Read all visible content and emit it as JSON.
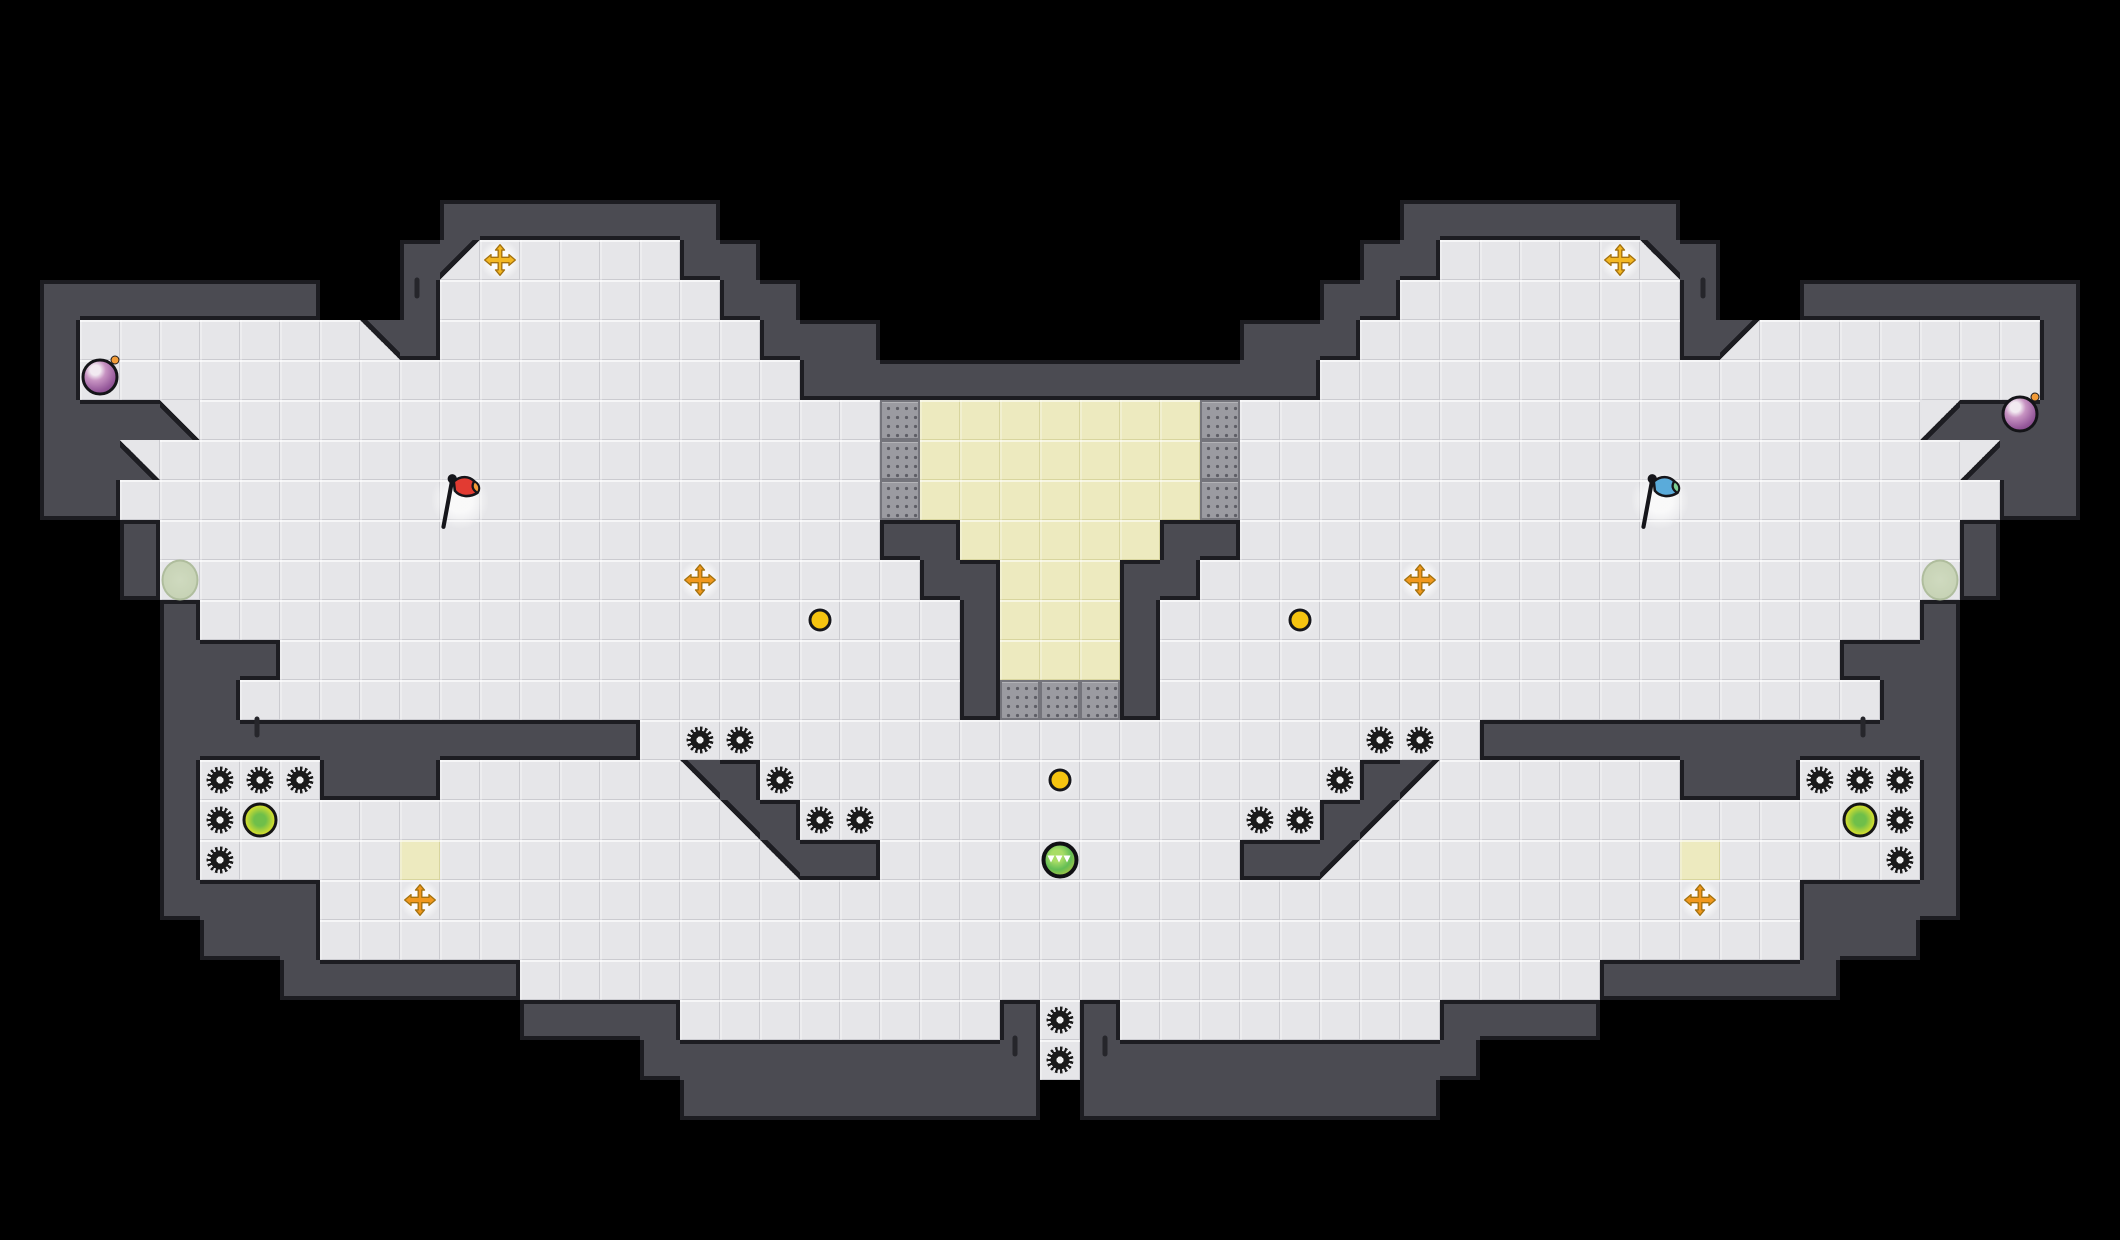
{
  "scene": {
    "description": "top-down tile arena map, capture-the-flag layout, mirrored left-right on black void",
    "background_color": "#000000"
  },
  "colors": {
    "void": "#000000",
    "wall_fill": "#4b4b52",
    "wall_edge": "#1d1d22",
    "floor": "#e6e6e9",
    "floor_line": "#cbcbd0",
    "sand_floor": "#edeabf",
    "dotted_block": "#9b9ba1",
    "dotted_dot": "#5e5e66",
    "mine": "#1b1b1b",
    "coin": "#f6c411",
    "orb_lime": "#d9e02e",
    "orb_ninja_green": "#63bd55",
    "cross_gold": "#f3b722",
    "cross_amber": "#f0981d",
    "bomb_purple": "#95589a",
    "bomb_spark": "#f29b38",
    "flag_red_body": "#e23b32",
    "flag_red_tip": "#f29b38",
    "flag_blue_body": "#5aabda",
    "flag_blue_tip": "#7ccf93",
    "spawn_oval": "#cfdabf"
  },
  "map": {
    "tile_size": 40,
    "cols": 53,
    "rows": 31,
    "legend": {
      " ": "void",
      "#": "wall",
      ".": "floor",
      "y": "sand-floor",
      "d": "dotted-block",
      "a": "wall-diagonal-top-left",
      "b": "wall-diagonal-top-right",
      "c": "wall-diagonal-bottom-left",
      "e": "wall-diagonal-bottom-right"
    },
    "grid": [
      "                                                     ",
      "                                                     ",
      "                                                     ",
      "                                                     ",
      "                                                     ",
      "           #######                 #######           ",
      "          #a.....##               ##.....b#          ",
      " #######  #.......##             ##.......#  ####### ",
      " #.......b#........###         ###........#a.......# ",
      " #..................#############..................# ",
      " ###c.................dyyyyyyyd.................e### ",
      " ##c..................dyyyyyyyd..................e## ",
      " ##...................dyyyyyyyd...................## ",
      "   #..................##yyyyy##..................#   ",
      "   #...................##yyy##...................#   ",
      "    #...................#yyy#...................#    ",
      "    ###.................#yyy#.................###    ",
      "    ##..................#ddd#..................##    ",
      "    ############.....................############    ",
      "    #...###......b#...............#a......###...#    ",
      "    #.............b#.............#a.............#    ",
      "    #.....y........b##.........##a........y.....#    ",
      "    ####.....................................####    ",
      "     ###.....................................###     ",
      "       ######...........................######       ",
      "             ####........#.#........####             ",
      "                ##########.##########                ",
      "                 ######### #########                 ",
      "                                                     ",
      "                                                     ",
      "                                                     "
    ]
  },
  "entities": {
    "mines": [
      [
        5,
        19
      ],
      [
        6,
        19
      ],
      [
        7,
        19
      ],
      [
        5,
        20
      ],
      [
        5,
        21
      ],
      [
        17,
        18
      ],
      [
        18,
        18
      ],
      [
        19,
        19
      ],
      [
        20,
        20
      ],
      [
        21,
        20
      ],
      [
        45,
        19
      ],
      [
        46,
        19
      ],
      [
        47,
        19
      ],
      [
        47,
        20
      ],
      [
        47,
        21
      ],
      [
        35,
        18
      ],
      [
        34,
        18
      ],
      [
        33,
        19
      ],
      [
        32,
        20
      ],
      [
        31,
        20
      ],
      [
        26,
        25
      ],
      [
        26,
        26
      ]
    ],
    "coins": [
      [
        20,
        15
      ],
      [
        32,
        15
      ],
      [
        26,
        19
      ]
    ],
    "power_orbs_lime": [
      [
        6,
        20
      ],
      [
        46,
        20
      ]
    ],
    "ninja_orbs": [
      [
        26,
        21
      ]
    ],
    "launch_crosses_gold": [
      [
        12,
        6
      ],
      [
        40,
        6
      ]
    ],
    "launch_crosses_amber": [
      [
        17,
        14
      ],
      [
        35,
        14
      ],
      [
        10,
        22
      ],
      [
        42,
        22
      ]
    ],
    "bombs": [
      [
        2,
        8
      ],
      [
        50,
        8
      ]
    ],
    "flags": [
      {
        "team": "red",
        "col": 11,
        "row": 12
      },
      {
        "team": "blue",
        "col": 41,
        "row": 12
      }
    ],
    "spawn_ovals": [
      [
        4,
        14
      ],
      [
        48,
        14
      ]
    ],
    "wall_marks": [
      [
        417,
        288
      ],
      [
        1703,
        288
      ],
      [
        257,
        727
      ],
      [
        1863,
        727
      ],
      [
        1015,
        1046
      ],
      [
        1105,
        1046
      ]
    ]
  }
}
